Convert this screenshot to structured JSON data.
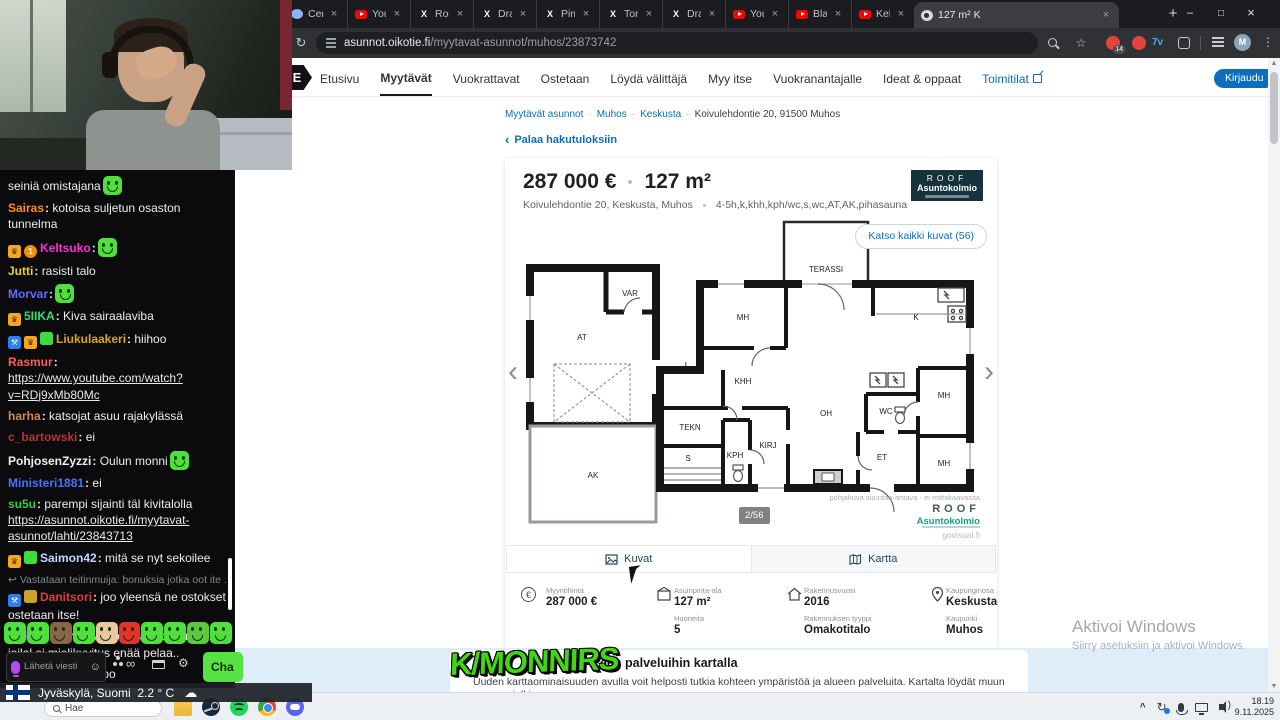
{
  "browser": {
    "tabs": [
      {
        "label": "Cent -"
      },
      {
        "label": "YouTube"
      },
      {
        "label": "Rockstar"
      },
      {
        "label": "DramaAl"
      },
      {
        "label": "Pimeys N"
      },
      {
        "label": "Tommy F"
      },
      {
        "label": "DramaAl"
      },
      {
        "label": "YouTube"
      },
      {
        "label": "Blashemi"
      },
      {
        "label": "Kel onni"
      },
      {
        "label": "127 m² K"
      }
    ],
    "url_domain": "asunnot.oikotie.fi",
    "url_path": "/myytavat-asunnot/muhos/23873742",
    "ext_badge": "14",
    "avatar_initial": "M"
  },
  "site": {
    "logo_letter": "E",
    "nav": [
      "Etusivu",
      "Myytävät",
      "Vuokrattavat",
      "Ostetaan",
      "Löydä välittäjä",
      "Myy itse",
      "Vuokranantajalle",
      "Ideat & oppaat",
      "Toimitilat"
    ],
    "login": "Kirjaudu",
    "breadcrumb": [
      "Myytävät asunnot",
      "Muhos",
      "Keskusta",
      "Koivulehdontie 20, 91500 Muhos"
    ],
    "back_link": "Palaa hakutuloksiin"
  },
  "listing": {
    "price": "287 000 €",
    "size": "127 m²",
    "address": "Koivulehdontie 20, Keskusta, Muhos",
    "rooms_spec": "4-5h,k,khh,kph/wc,s,wc,AT,AK,pihasauna",
    "agency_name": "ROOF",
    "agency_sub": "Asuntokolmio",
    "photos_button": "Katso kaikki kuvat (56)",
    "photo_counter": "2/56",
    "floorplan_note": "pohjakuva suuntaa-antava - ei mittakaavassa",
    "floorplan_brand": "ROOF",
    "floorplan_brand2": "Asuntokolmio",
    "floorplan_credit": "govisual.fi",
    "rooms": [
      "VAR",
      "AT",
      "AK",
      "TERASSI",
      "MH",
      "K",
      "KHH",
      "TEKN",
      "S",
      "KPH",
      "KIRJ",
      "OH",
      "WC",
      "MH",
      "ET",
      "MH"
    ],
    "view_tabs": [
      {
        "label": "Kuvat"
      },
      {
        "label": "Kartta"
      }
    ],
    "facts": [
      {
        "label": "Myyntihinta",
        "value": "287 000 €"
      },
      {
        "label": "Asuinpinta-ala",
        "value": "127 m²"
      },
      {
        "label": "Rakennusvuosi",
        "value": "2016"
      },
      {
        "label": "Kaupunginosa",
        "value": "Keskusta"
      },
      {
        "label": "Huoneita",
        "value": "5"
      },
      {
        "label": "Rakennuksen tyyppi",
        "value": "Omakotitalo"
      },
      {
        "label": "Kaupunki",
        "value": "Muhos"
      }
    ],
    "teaser_heading": "een palveluihin kartalla",
    "teaser_text": "Uuden karttaominaisuuden avulla voit helposti tutkia kohteen ympäristöä ja alueen palveluita. Kartalta löydät muun muassa julkisen"
  },
  "chat": {
    "messages": [
      {
        "text": "seiniä omistajana"
      },
      {
        "user": "Sairas",
        "color": "#ff8c19",
        "text": "kotoisa suljetun osaston tunnelma"
      },
      {
        "user": "Keltsuko",
        "color": "#ff2fd2",
        "text": ""
      },
      {
        "user": "Jutti",
        "color": "#e8d126",
        "text": "rasisti talo"
      },
      {
        "user": "Morvar",
        "color": "#5f6dff",
        "text": ""
      },
      {
        "user": "5IIKA",
        "color": "#2fe077",
        "text": "Kiva sairaalaviba"
      },
      {
        "user": "Liukulaakeri",
        "color": "#d6a51c",
        "text": "hiihoo"
      },
      {
        "user": "Rasmur",
        "color": "#ff5a5a",
        "link": "https://www.youtube.com/watch?v=RDj9xMb80Mc"
      },
      {
        "user": "harha",
        "color": "#cd8a54",
        "text": "katsojat asuu rajakylässä"
      },
      {
        "user": "c_bartowski",
        "color": "#b93333",
        "text": "ei"
      },
      {
        "user": "PohjosenZyzzi",
        "color": "#efeff1",
        "text": "Oulun monni"
      },
      {
        "user": "Ministeri1881",
        "color": "#4873ff",
        "text": "ei"
      },
      {
        "user": "su5u",
        "color": "#2fc94c",
        "text": "parempi sijainti täl kivitalolla",
        "link": "https://asunnot.oikotie.fi/myytavat-asunnot/lahti/23843713"
      },
      {
        "user": "Saimon42",
        "color": "#bfd9ff",
        "text": "mitä se nyt sekoilee"
      },
      {
        "reply": "Vastataan teitinmuija: bonuksia jotka oot ite …",
        "user": "Danitsori",
        "color": "#e23b3b",
        "text": "joo yleensä ne ostokset ostetaan itse!"
      },
      {
        "user": "Nuking",
        "color": "#a34dff",
        "text": "täysin valkone talo on ihmisille joilal ei mielikuvitus enää pelaa.."
      },
      {
        "user": "PohjosenZyzzi",
        "color": "#efeff1",
        "text": "joo"
      }
    ],
    "emote_colors": [
      "#4ee13b",
      "#4ee13b",
      "#8a6647",
      "#4ee13b",
      "#e8c7a2",
      "#e03528",
      "#4ee13b",
      "#4ee13b",
      "#5cc93e",
      "#4ee13b"
    ],
    "placeholder": "Lähetä viesti",
    "send_button": "Cha"
  },
  "overlay": {
    "brand": "K/MONNIRS"
  },
  "windows": {
    "activate_line1": "Aktivoi Windows",
    "activate_line2": "Siirry asetuksiin ja aktivoi Windows.",
    "weather_location": "Jyväskylä, Suomi",
    "weather_temp": "2.2 ° C",
    "search": "Hae",
    "time": "18.19",
    "date": "9.11.2025"
  }
}
